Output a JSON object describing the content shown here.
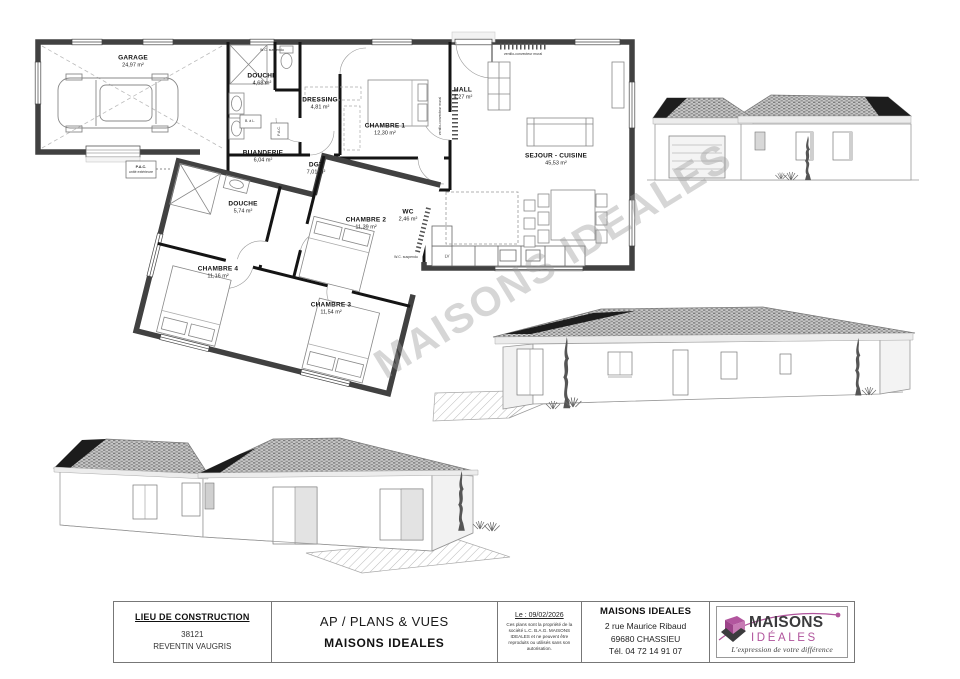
{
  "watermark": {
    "text": "MAISONS IDEALES"
  },
  "floor_plan": {
    "rooms": [
      {
        "name": "GARAGE",
        "area": "24,97 m²"
      },
      {
        "name": "DOUCHE",
        "area": "4,68 m²"
      },
      {
        "name": "DRESSING",
        "area": "4,81 m²"
      },
      {
        "name": "CHAMBRE 1",
        "area": "12,30 m²"
      },
      {
        "name": "HALL",
        "area": "4,27 m²"
      },
      {
        "name": "SEJOUR - CUISINE",
        "area": "45,53 m²"
      },
      {
        "name": "BUANDERIE",
        "area": "6,04 m²"
      },
      {
        "name": "DGT",
        "area": "7,01 m²"
      },
      {
        "name": "DOUCHE",
        "area": "5,74 m²"
      },
      {
        "name": "CHAMBRE 2",
        "area": "11,39 m²"
      },
      {
        "name": "WC",
        "area": "2,46 m²"
      },
      {
        "name": "CHAMBRE 4",
        "area": "11,16 m²"
      },
      {
        "name": "CHAMBRE 3",
        "area": "11,54 m²"
      }
    ],
    "annotations": {
      "wc_suspendu_1": "W.C. suspendu",
      "wc_suspendu_2": "W.C. suspendu",
      "ventilo_1": "ventilo-convecteur mural",
      "ventilo_2": "ventilo-convecteur mural",
      "pac_line1": "P.A.C.",
      "pac_line2": "unité extérieure",
      "pac_int": "P.A.C.",
      "bal": "B. à L.",
      "lv": "LV"
    }
  },
  "title_block": {
    "location": {
      "heading": "LIEU DE CONSTRUCTION",
      "postal_code": "38121",
      "city": "REVENTIN VAUGRIS"
    },
    "plan": {
      "type": "AP / PLANS & VUES",
      "company": "MAISONS IDEALES"
    },
    "date": {
      "label": "Le : 09/02/2026",
      "notice": "Ces plans sont la propriété de la société L.C. B.A.G. MAISONS IDEALES et ne peuvent être reproduits ou utilisés sans son autorisation."
    },
    "company": {
      "name": "MAISONS IDEALES",
      "address1": "2 rue Maurice Ribaud",
      "address2": "69680 CHASSIEU",
      "phone": "Tél. 04 72 14 91 07"
    },
    "logo": {
      "word1": "MAISONS",
      "word2": "IDÉALES",
      "tagline": "L'expression de votre différence",
      "accent": "#b0549c",
      "dark": "#3b3b3d"
    }
  }
}
